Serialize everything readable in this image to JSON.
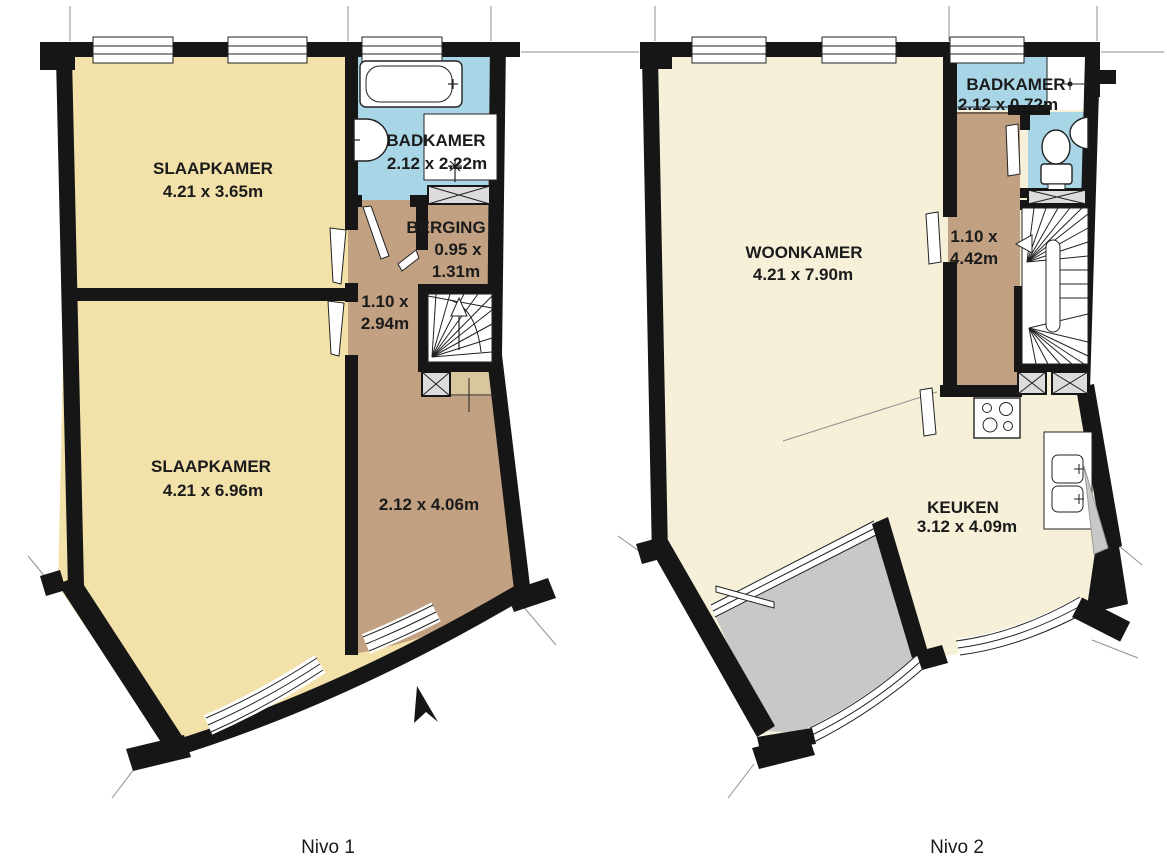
{
  "document": {
    "type": "floor-plan",
    "language": "nl"
  },
  "colors": {
    "wall": "#161616",
    "floor_warm": "#F2E1A9",
    "floor_pale": "#F6F0D9",
    "hall_tan": "#C1A181",
    "hall_tan_light": "#D9C69E",
    "wet_blue": "#A9D6E7",
    "balcony_gray": "#C8C8C8",
    "duct_gray": "#DCDCDC",
    "line": "#222222",
    "text": "#1B1B1B",
    "refline": "#8F8F8F"
  },
  "nivo1": {
    "caption": "Nivo 1",
    "slaapkamer_boven": {
      "name": "SLAAPKAMER",
      "dim": "4.21 x 3.65m"
    },
    "badkamer": {
      "name": "BADKAMER",
      "dim": "2.12 x 2.22m"
    },
    "berging": {
      "name": "BERGING",
      "dim_line1": "0.95 x",
      "dim_line2": "1.31m"
    },
    "overloop": {
      "dim_line1": "1.10 x",
      "dim_line2": "2.94m"
    },
    "slaapkamer_onder": {
      "name": "SLAAPKAMER",
      "dim": "4.21 x 6.96m"
    },
    "hal": {
      "dim": "2.12 x 4.06m"
    }
  },
  "nivo2": {
    "caption": "Nivo 2",
    "woonkamer": {
      "name": "WOONKAMER",
      "dim": "4.21 x 7.90m"
    },
    "badkamer": {
      "name": "BADKAMER",
      "dim": "2.12 x 0.72m"
    },
    "overloop": {
      "dim_line1": "1.10 x",
      "dim_line2": "4.42m"
    },
    "keuken": {
      "name": "KEUKEN",
      "dim": "3.12 x 4.09m"
    }
  }
}
